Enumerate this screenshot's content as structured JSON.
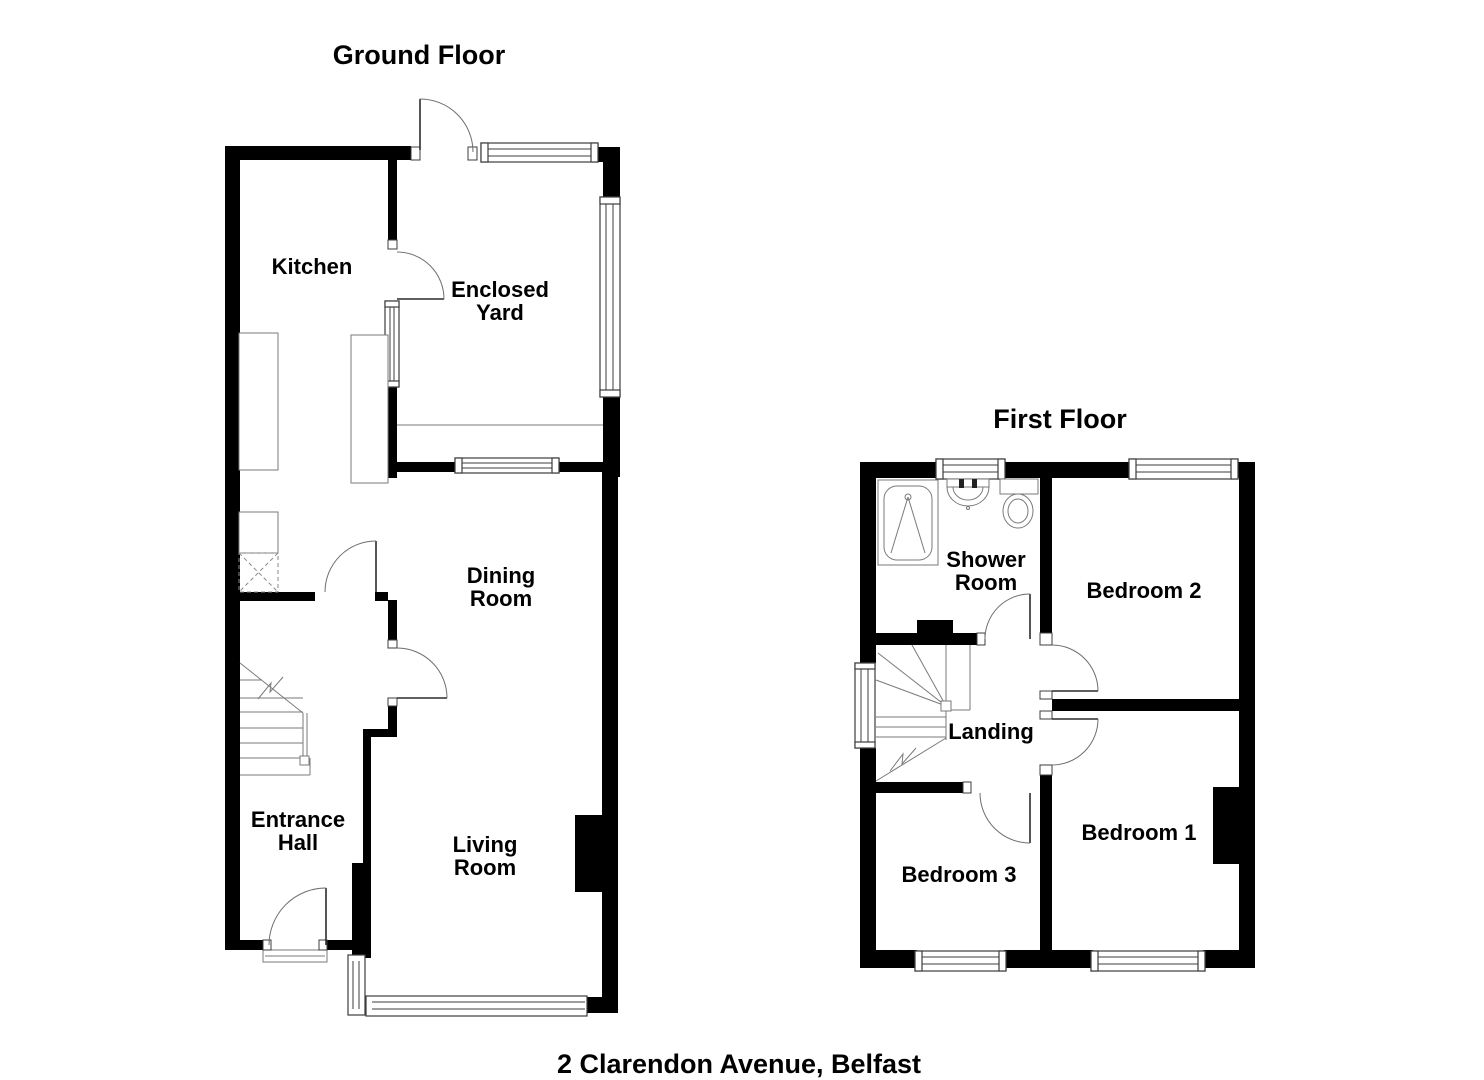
{
  "page": {
    "background_color": "#ffffff",
    "wall_color": "#000000",
    "detail_line_color": "#7a7a7a",
    "text_color": "#000000"
  },
  "caption": {
    "address": "2 Clarendon Avenue, Belfast"
  },
  "ground_floor": {
    "title": "Ground Floor",
    "rooms": {
      "kitchen": {
        "label": "Kitchen"
      },
      "enclosed_yard": {
        "line1": "Enclosed",
        "line2": "Yard"
      },
      "dining_room": {
        "line1": "Dining",
        "line2": "Room"
      },
      "entrance_hall": {
        "line1": "Entrance",
        "line2": "Hall"
      },
      "living_room": {
        "line1": "Living",
        "line2": "Room"
      }
    }
  },
  "first_floor": {
    "title": "First Floor",
    "rooms": {
      "shower_room": {
        "line1": "Shower",
        "line2": "Room"
      },
      "bedroom_2": {
        "label": "Bedroom 2"
      },
      "landing": {
        "label": "Landing"
      },
      "bedroom_1": {
        "label": "Bedroom 1"
      },
      "bedroom_3": {
        "label": "Bedroom 3"
      }
    }
  }
}
